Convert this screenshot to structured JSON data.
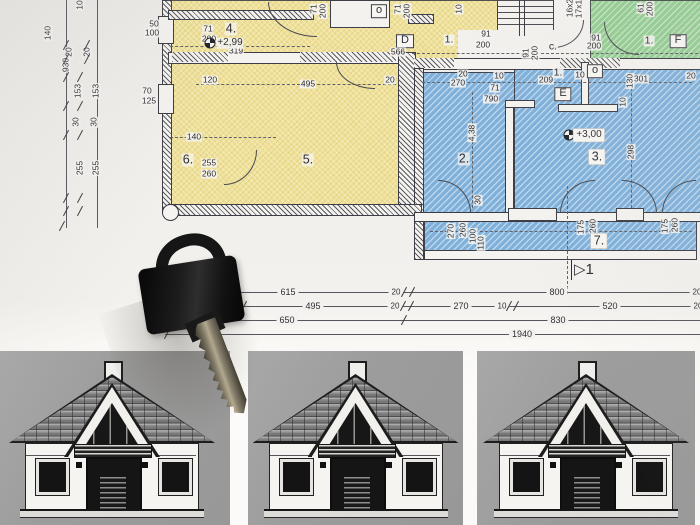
{
  "scene": {
    "description": "floor plan blueprint with door key and three house elevation drawings"
  },
  "colors": {
    "paper": "#f2f0ec",
    "room_yellow": "#efe198",
    "room_blue": "#7fb0da",
    "room_green": "#94cc92",
    "panel_gray": "#9f9f9f",
    "ink": "#3a3a42",
    "key_black": "#171717"
  },
  "plan": {
    "labels": [
      {
        "t": "50",
        "x": 154,
        "y": 24
      },
      {
        "t": "100",
        "x": 152,
        "y": 33
      },
      {
        "t": "70",
        "x": 147,
        "y": 91
      },
      {
        "t": "125",
        "x": 149,
        "y": 101
      },
      {
        "t": "4.",
        "x": 231,
        "y": 29,
        "s": "room"
      },
      {
        "t": "319",
        "x": 236,
        "y": 51
      },
      {
        "t": "71",
        "x": 208,
        "y": 29
      },
      {
        "t": "200",
        "x": 209,
        "y": 39
      },
      {
        "t": "120",
        "x": 210,
        "y": 80
      },
      {
        "t": "495",
        "x": 308,
        "y": 84
      },
      {
        "t": "5.",
        "x": 308,
        "y": 160,
        "s": "room"
      },
      {
        "t": "140",
        "x": 194,
        "y": 137
      },
      {
        "t": "6.",
        "x": 188,
        "y": 160,
        "s": "room"
      },
      {
        "t": "255",
        "x": 209,
        "y": 163
      },
      {
        "t": "260",
        "x": 209,
        "y": 174
      },
      {
        "t": "71",
        "x": 314,
        "y": 9,
        "r": 1
      },
      {
        "t": "200",
        "x": 323,
        "y": 11,
        "r": 1
      },
      {
        "t": "71",
        "x": 398,
        "y": 9,
        "r": 1
      },
      {
        "t": "200",
        "x": 407,
        "y": 11,
        "r": 1
      },
      {
        "t": "10",
        "x": 459,
        "y": 9,
        "r": 1
      },
      {
        "t": "o",
        "x": 379,
        "y": 11,
        "s": "box"
      },
      {
        "t": "D",
        "x": 405,
        "y": 41,
        "s": "box"
      },
      {
        "t": "1.",
        "x": 449,
        "y": 40,
        "s": "room-sm"
      },
      {
        "t": "566",
        "x": 398,
        "y": 52
      },
      {
        "t": "20",
        "x": 390,
        "y": 80
      },
      {
        "t": "91",
        "x": 486,
        "y": 34
      },
      {
        "t": "200",
        "x": 483,
        "y": 45
      },
      {
        "t": "91",
        "x": 526,
        "y": 53,
        "r": 1
      },
      {
        "t": "200",
        "x": 535,
        "y": 53,
        "r": 1
      },
      {
        "t": "c.",
        "x": 553,
        "y": 47,
        "s": "room-sm"
      },
      {
        "t": "16x2",
        "x": 570,
        "y": 8,
        "r": 1
      },
      {
        "t": "17x1",
        "x": 579,
        "y": 9,
        "r": 1
      },
      {
        "t": "91",
        "x": 596,
        "y": 38
      },
      {
        "t": "200",
        "x": 594,
        "y": 46
      },
      {
        "t": "61",
        "x": 641,
        "y": 8,
        "r": 1
      },
      {
        "t": "200",
        "x": 650,
        "y": 9,
        "r": 1
      },
      {
        "t": "1.",
        "x": 649,
        "y": 41,
        "s": "room-sm"
      },
      {
        "t": "F",
        "x": 678,
        "y": 41,
        "s": "box"
      },
      {
        "t": "20",
        "x": 463,
        "y": 74
      },
      {
        "t": "270",
        "x": 458,
        "y": 83
      },
      {
        "t": "10",
        "x": 499,
        "y": 76
      },
      {
        "t": "209",
        "x": 546,
        "y": 80
      },
      {
        "t": "1.",
        "x": 558,
        "y": 73,
        "s": "room-sm"
      },
      {
        "t": "10",
        "x": 580,
        "y": 75
      },
      {
        "t": "o",
        "x": 595,
        "y": 71,
        "s": "box"
      },
      {
        "t": "301",
        "x": 641,
        "y": 79
      },
      {
        "t": "130",
        "x": 630,
        "y": 81,
        "r": 1
      },
      {
        "t": "20",
        "x": 691,
        "y": 76
      },
      {
        "t": "E",
        "x": 563,
        "y": 94,
        "s": "box"
      },
      {
        "t": "71",
        "x": 495,
        "y": 88
      },
      {
        "t": "790",
        "x": 491,
        "y": 99
      },
      {
        "t": "4,38",
        "x": 472,
        "y": 133,
        "r": 1
      },
      {
        "t": "10",
        "x": 623,
        "y": 102,
        "r": 1
      },
      {
        "t": "2.",
        "x": 464,
        "y": 159,
        "s": "room"
      },
      {
        "t": "3.",
        "x": 597,
        "y": 157,
        "s": "room chip"
      },
      {
        "t": "298",
        "x": 631,
        "y": 152,
        "r": 1
      },
      {
        "t": "30",
        "x": 478,
        "y": 200,
        "r": 1
      },
      {
        "t": "270",
        "x": 451,
        "y": 231,
        "r": 1
      },
      {
        "t": "260",
        "x": 463,
        "y": 230,
        "r": 1
      },
      {
        "t": "100",
        "x": 473,
        "y": 236,
        "r": 1
      },
      {
        "t": "110",
        "x": 481,
        "y": 243,
        "r": 1
      },
      {
        "t": "175",
        "x": 581,
        "y": 227,
        "r": 1
      },
      {
        "t": "260",
        "x": 593,
        "y": 226,
        "r": 1
      },
      {
        "t": "7.",
        "x": 599,
        "y": 241,
        "s": "room chip"
      },
      {
        "t": "175",
        "x": 665,
        "y": 226,
        "r": 1
      },
      {
        "t": "260",
        "x": 675,
        "y": 225,
        "r": 1
      }
    ],
    "chain_labels": [
      {
        "t": "10",
        "x": 80,
        "y": 5
      },
      {
        "t": "140",
        "x": 48,
        "y": 33
      },
      {
        "t": "20",
        "x": 69,
        "y": 52
      },
      {
        "t": "20",
        "x": 87,
        "y": 52
      },
      {
        "t": "930",
        "x": 66,
        "y": 65
      },
      {
        "t": "153",
        "x": 78,
        "y": 91
      },
      {
        "t": "153",
        "x": 96,
        "y": 91
      },
      {
        "t": "30",
        "x": 76,
        "y": 122
      },
      {
        "t": "30",
        "x": 94,
        "y": 122
      },
      {
        "t": "255",
        "x": 80,
        "y": 168
      },
      {
        "t": "255",
        "x": 96,
        "y": 168
      }
    ],
    "chain_ticks": [
      [
        66,
        45
      ],
      [
        87,
        45
      ],
      [
        66,
        59
      ],
      [
        87,
        59
      ],
      [
        66,
        77
      ],
      [
        80,
        77
      ],
      [
        66,
        106
      ],
      [
        80,
        106
      ],
      [
        66,
        135
      ],
      [
        80,
        135
      ],
      [
        66,
        198
      ],
      [
        80,
        198
      ],
      [
        66,
        211
      ],
      [
        80,
        211
      ],
      [
        62,
        226
      ]
    ],
    "dim_rows": [
      {
        "y": 292,
        "x1": 233,
        "x2": 700,
        "labels": [
          {
            "t": "615",
            "cx": 288
          },
          {
            "t": "20",
            "cx": 396,
            "sm": 1
          },
          {
            "t": "800",
            "cx": 557
          },
          {
            "t": "20",
            "cx": 697,
            "sm": 1
          }
        ],
        "ticks": [
          404,
          412
        ]
      },
      {
        "y": 306,
        "x1": 243,
        "x2": 700,
        "labels": [
          {
            "t": "495",
            "cx": 313
          },
          {
            "t": "20",
            "cx": 395,
            "sm": 1
          },
          {
            "t": "270",
            "cx": 461
          },
          {
            "t": "10",
            "cx": 502,
            "sm": 1
          },
          {
            "t": "520",
            "cx": 610
          },
          {
            "t": "20",
            "cx": 698,
            "sm": 1
          }
        ],
        "ticks": [
          244,
          403,
          411,
          509,
          516
        ]
      },
      {
        "y": 320,
        "x1": 217,
        "x2": 700,
        "labels": [
          {
            "t": "650",
            "cx": 287
          },
          {
            "t": "830",
            "cx": 558
          }
        ],
        "ticks": [
          218,
          404
        ]
      },
      {
        "y": 334,
        "x1": 165,
        "x2": 700,
        "labels": [
          {
            "t": "1940",
            "cx": 522
          }
        ],
        "ticks": [
          167
        ]
      }
    ],
    "arcs": [
      {
        "x": 268,
        "y": 2,
        "w": 48,
        "h": 34,
        "c": "bl"
      },
      {
        "x": 336,
        "y": 62,
        "w": 38,
        "h": 26,
        "c": "bl"
      },
      {
        "x": 224,
        "y": 150,
        "w": 32,
        "h": 34,
        "c": "br"
      },
      {
        "x": 604,
        "y": 22,
        "w": 34,
        "h": 32,
        "c": "bl"
      },
      {
        "x": 553,
        "y": 20,
        "w": 30,
        "h": 27,
        "c": "br"
      },
      {
        "x": 438,
        "y": 180,
        "w": 32,
        "h": 32,
        "c": "tr"
      },
      {
        "x": 560,
        "y": 180,
        "w": 34,
        "h": 32,
        "c": "tl"
      },
      {
        "x": 622,
        "y": 180,
        "w": 34,
        "h": 32,
        "c": "tr"
      },
      {
        "x": 662,
        "y": 180,
        "w": 33,
        "h": 32,
        "c": "tl"
      }
    ],
    "level_markers": [
      {
        "t": "+2,99",
        "x": 230,
        "y": 43,
        "chip": 0
      },
      {
        "t": "+3,00",
        "x": 589,
        "y": 135,
        "chip": 1
      }
    ],
    "section_marker": {
      "glyph": "▷",
      "num": "1"
    }
  },
  "houses": {
    "panels": [
      {
        "x": -6,
        "y": 351,
        "w": 236
      },
      {
        "x": 248,
        "y": 351,
        "w": 215
      },
      {
        "x": 477,
        "y": 351,
        "w": 218
      }
    ]
  },
  "key": {
    "name": "black door key"
  }
}
